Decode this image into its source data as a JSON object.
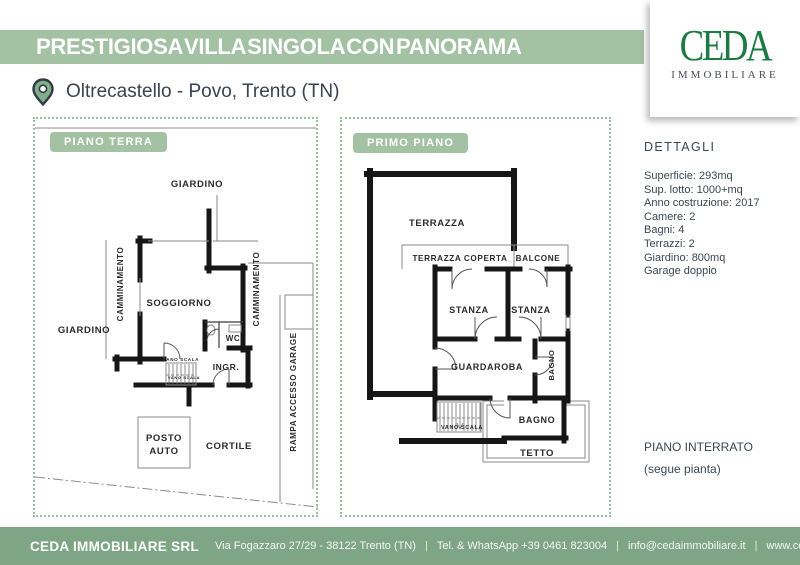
{
  "header": {
    "title": "PRESTIGIOSA VILLA SINGOLA CON PANORAMA",
    "location": "Oltrecastello - Povo, Trento (TN)",
    "logo_text": "CEDA",
    "logo_subtitle": "IMMOBILIARE"
  },
  "floor_plans": {
    "ground": {
      "badge": "PIANO TERRA",
      "labels": {
        "giardino_top": "GIARDINO",
        "giardino_left": "GIARDINO",
        "camminamento_left": "CAMMINAMENTO",
        "camminamento_right": "CAMMINAMENTO",
        "soggiorno": "SOGGIORNO",
        "wc": "WC",
        "ingresso": "INGR.",
        "vano_scala": "VANO SCALA",
        "rampa": "RAMPA ACCESSO GARAGE",
        "posto_auto_line1": "POSTO",
        "posto_auto_line2": "AUTO",
        "cortile": "CORTILE"
      }
    },
    "first": {
      "badge": "PRIMO PIANO",
      "labels": {
        "terrazza": "TERRAZZA",
        "terrazza_coperta": "TERRAZZA COPERTA",
        "balcone": "BALCONE",
        "stanza_1": "STANZA",
        "stanza_2": "STANZA",
        "guardaroba": "GUARDAROBA",
        "bagno_piccolo": "BAGNO",
        "bagno": "BAGNO",
        "vano_scala": "VANO SCALA",
        "tetto": "TETTO"
      }
    }
  },
  "details": {
    "heading": "DETTAGLI",
    "lines": [
      "Superficie: 293mq",
      "Sup. lotto: 1000+mq",
      "Anno costruzione: 2017",
      "Camere: 2",
      "Bagni: 4",
      "Terrazzi: 2",
      "Giardino: 800mq",
      "Garage doppio"
    ],
    "basement_note_line1": "PIANO INTERRATO",
    "basement_note_line2": "(segue pianta)"
  },
  "footer": {
    "company": "CEDA IMMOBILIARE SRL",
    "address": "Via Fogazzaro 27/29 - 38122 Trento (TN)",
    "phone": "Tel. & WhatsApp +39 0461 823004",
    "email": "info@cedaimmobiliare.it",
    "website": "www.cedaimmobiliare.it",
    "separator": "|"
  },
  "colors": {
    "banner_green": "#a3c1a3",
    "footer_green": "#7ea585",
    "logo_green": "#1d7a45",
    "dotted_border_green": "#9cbe9e",
    "text_dark": "#3c4750",
    "wall_black": "#161616",
    "line_gray": "#8a8a8a",
    "pin_green": "#84ae89"
  }
}
